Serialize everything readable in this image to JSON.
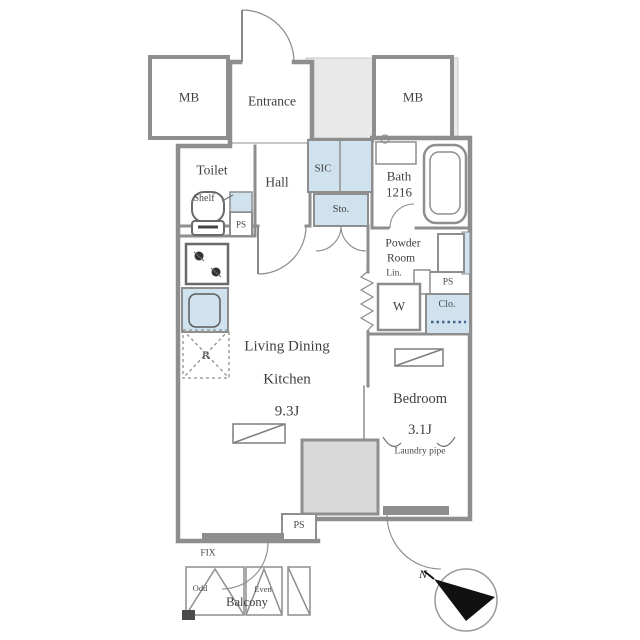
{
  "colors": {
    "wall": "#8e8e8e",
    "water_fixture_fill": "#cfe2ee",
    "exterior_fill": "#e9e9e9",
    "window_band": "#8e8e8e",
    "column_fill": "#d9d9d9",
    "text": "#3f3f3f",
    "compass_arrow": "#111111"
  },
  "rooms": {
    "mb_left": {
      "label": "MB"
    },
    "mb_right": {
      "label": "MB"
    },
    "entrance": {
      "label": "Entrance"
    },
    "toilet": {
      "label": "Toilet",
      "shelf": "Shelf",
      "ps": "PS"
    },
    "hall": {
      "label": "Hall"
    },
    "sic": {
      "label": "SIC"
    },
    "storage": {
      "label": "Sto."
    },
    "bath": {
      "name": "Bath",
      "size": "1216"
    },
    "powder_room": {
      "line1": "Powder",
      "line2": "Room",
      "linen": "Lin.",
      "washer": "W",
      "ps": "PS",
      "closet": "Clo."
    },
    "ldk": {
      "line1": "Living Dining",
      "line2": "Kitchen",
      "size": "9.3J",
      "fridge": "R",
      "ps": "PS"
    },
    "bedroom": {
      "label": "Bedroom",
      "size": "3.1J",
      "laundry": "Laundry pipe"
    },
    "balcony": {
      "label": "Balcony",
      "fix": "FIX",
      "panel_odd": "Odd",
      "panel_even": "Even"
    }
  },
  "compass": {
    "north_label": "N"
  }
}
